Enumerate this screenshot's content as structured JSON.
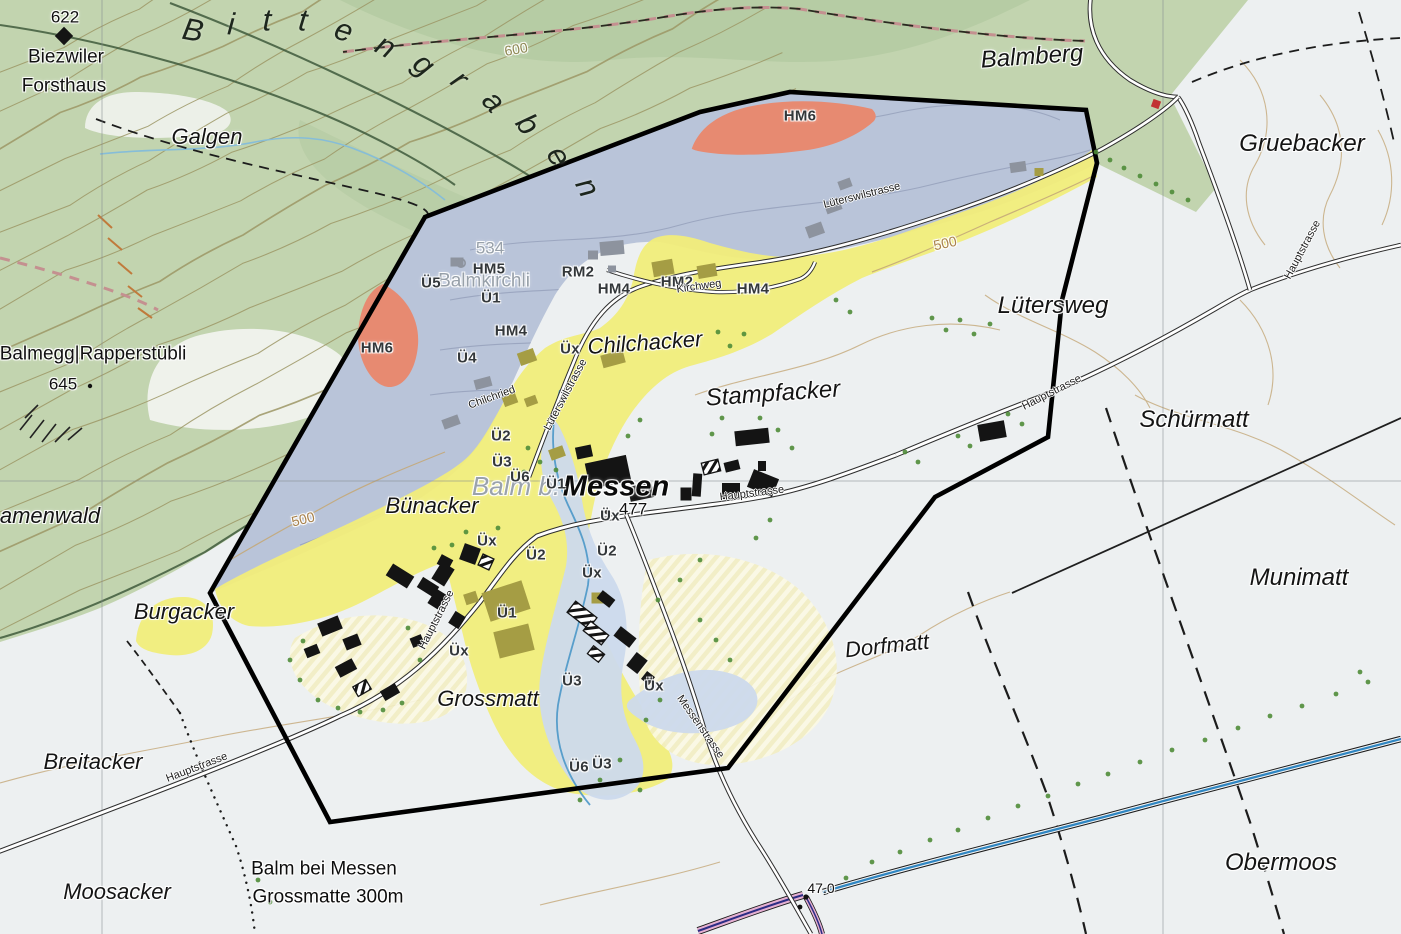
{
  "map": {
    "spread_label": "Bittengraben",
    "labels": [
      {
        "t": "Galgen",
        "x": 207,
        "y": 137,
        "r": 0,
        "c": "place"
      },
      {
        "t": "Balmberg",
        "x": 1032,
        "y": 57,
        "r": -4,
        "c": "place-lg"
      },
      {
        "t": "Gruebacker",
        "x": 1302,
        "y": 144,
        "r": 0,
        "c": "place-lg"
      },
      {
        "t": "Lütersweg",
        "x": 1053,
        "y": 306,
        "r": 0,
        "c": "place-lg"
      },
      {
        "t": "Schürmatt",
        "x": 1194,
        "y": 420,
        "r": 0,
        "c": "place-lg"
      },
      {
        "t": "Munimatt",
        "x": 1299,
        "y": 578,
        "r": 0,
        "c": "place-lg"
      },
      {
        "t": "Stampfacker",
        "x": 773,
        "y": 394,
        "r": -4,
        "c": "place-lg"
      },
      {
        "t": "Obermoos",
        "x": 1281,
        "y": 863,
        "r": 0,
        "c": "place-lg"
      },
      {
        "t": "Dorfmatt",
        "x": 887,
        "y": 646,
        "r": -6,
        "c": "place"
      },
      {
        "t": "Bünacker",
        "x": 432,
        "y": 506,
        "r": 0,
        "c": "place"
      },
      {
        "t": "Burgacker",
        "x": 184,
        "y": 612,
        "r": 0,
        "c": "place"
      },
      {
        "t": "Breitacker",
        "x": 93,
        "y": 762,
        "r": 0,
        "c": "place"
      },
      {
        "t": "Moosacker",
        "x": 117,
        "y": 892,
        "r": 0,
        "c": "place"
      },
      {
        "t": "amenwald",
        "x": 50,
        "y": 516,
        "r": 0,
        "c": "place"
      },
      {
        "t": "Chilchacker",
        "x": 645,
        "y": 343,
        "r": -4,
        "c": "place"
      },
      {
        "t": "Grossmatt",
        "x": 488,
        "y": 699,
        "r": 0,
        "c": "place"
      },
      {
        "t": "Biezwiler",
        "x": 66,
        "y": 57,
        "r": 0,
        "c": "settlement"
      },
      {
        "t": "Forsthaus",
        "x": 64,
        "y": 86,
        "r": 0,
        "c": "settlement"
      },
      {
        "t": "Balmegg|Rapperstübli",
        "x": 93,
        "y": 354,
        "r": 0,
        "c": "settlement"
      },
      {
        "t": "Balmkirchli",
        "x": 484,
        "y": 281,
        "r": 0,
        "c": "gray-name"
      },
      {
        "t": "Balm b.",
        "x": 516,
        "y": 486,
        "r": 0,
        "c": "village-gray"
      },
      {
        "t": "Messen",
        "x": 616,
        "y": 487,
        "r": 0,
        "c": "village-black"
      },
      {
        "t": "534",
        "x": 490,
        "y": 248,
        "r": 0,
        "c": "spot-gray"
      },
      {
        "t": "622",
        "x": 65,
        "y": 17,
        "r": 0,
        "c": "spot"
      },
      {
        "t": "645",
        "x": 63,
        "y": 384,
        "r": 0,
        "c": "spot"
      },
      {
        "t": "477",
        "x": 633,
        "y": 509,
        "r": 0,
        "c": "spot"
      },
      {
        "t": "47.0",
        "x": 821,
        "y": 888,
        "r": 0,
        "c": "spot-sm"
      },
      {
        "t": "Balm bei Messen",
        "x": 324,
        "y": 869,
        "r": 0,
        "c": "bus"
      },
      {
        "t": "Grossmatte 300m",
        "x": 328,
        "y": 897,
        "r": 0,
        "c": "bus"
      },
      {
        "t": "HM6",
        "x": 800,
        "y": 116,
        "r": 0,
        "c": "code"
      },
      {
        "t": "HM6",
        "x": 377,
        "y": 348,
        "r": 0,
        "c": "code"
      },
      {
        "t": "HM5",
        "x": 489,
        "y": 269,
        "r": 0,
        "c": "code"
      },
      {
        "t": "Ü5",
        "x": 431,
        "y": 283,
        "r": 0,
        "c": "code"
      },
      {
        "t": "Ü1",
        "x": 491,
        "y": 298,
        "r": 0,
        "c": "code"
      },
      {
        "t": "RM2",
        "x": 578,
        "y": 272,
        "r": 0,
        "c": "code"
      },
      {
        "t": "HM4",
        "x": 614,
        "y": 289,
        "r": 0,
        "c": "code"
      },
      {
        "t": "HM2",
        "x": 677,
        "y": 282,
        "r": 0,
        "c": "code"
      },
      {
        "t": "HM4",
        "x": 753,
        "y": 289,
        "r": 0,
        "c": "code"
      },
      {
        "t": "HM4",
        "x": 511,
        "y": 331,
        "r": 0,
        "c": "code"
      },
      {
        "t": "Üx",
        "x": 570,
        "y": 349,
        "r": 0,
        "c": "code"
      },
      {
        "t": "Ü4",
        "x": 467,
        "y": 358,
        "r": 0,
        "c": "code"
      },
      {
        "t": "Ü2",
        "x": 501,
        "y": 436,
        "r": 0,
        "c": "code"
      },
      {
        "t": "Ü3",
        "x": 502,
        "y": 462,
        "r": 0,
        "c": "code"
      },
      {
        "t": "Ü6",
        "x": 520,
        "y": 477,
        "r": 0,
        "c": "code"
      },
      {
        "t": "Ü1",
        "x": 556,
        "y": 484,
        "r": 0,
        "c": "code"
      },
      {
        "t": "Üx",
        "x": 610,
        "y": 516,
        "r": 0,
        "c": "code"
      },
      {
        "t": "Ü2",
        "x": 536,
        "y": 555,
        "r": 0,
        "c": "code"
      },
      {
        "t": "Ü2",
        "x": 607,
        "y": 551,
        "r": 0,
        "c": "code"
      },
      {
        "t": "Üx",
        "x": 487,
        "y": 541,
        "r": 0,
        "c": "code"
      },
      {
        "t": "Üx",
        "x": 592,
        "y": 573,
        "r": 0,
        "c": "code"
      },
      {
        "t": "Ü1",
        "x": 507,
        "y": 613,
        "r": 0,
        "c": "code"
      },
      {
        "t": "Üx",
        "x": 459,
        "y": 651,
        "r": 0,
        "c": "code"
      },
      {
        "t": "Ü3",
        "x": 572,
        "y": 681,
        "r": 0,
        "c": "code"
      },
      {
        "t": "Üx",
        "x": 654,
        "y": 686,
        "r": 0,
        "c": "code"
      },
      {
        "t": "Ü6",
        "x": 579,
        "y": 767,
        "r": 0,
        "c": "code"
      },
      {
        "t": "Ü3",
        "x": 602,
        "y": 764,
        "r": 0,
        "c": "code"
      },
      {
        "t": "Lüterswilstrasse",
        "x": 862,
        "y": 196,
        "r": -14,
        "c": "road"
      },
      {
        "t": "Lüterswilstrasse",
        "x": 566,
        "y": 395,
        "r": -62,
        "c": "road"
      },
      {
        "t": "Kirchweg",
        "x": 699,
        "y": 287,
        "r": -8,
        "c": "road"
      },
      {
        "t": "Chilchried",
        "x": 492,
        "y": 398,
        "r": -20,
        "c": "road"
      },
      {
        "t": "Hauptstrasse",
        "x": 752,
        "y": 494,
        "r": -7,
        "c": "road"
      },
      {
        "t": "Hauptstrasse",
        "x": 1052,
        "y": 393,
        "r": -27,
        "c": "road"
      },
      {
        "t": "Hauptstrasse",
        "x": 1303,
        "y": 250,
        "r": -62,
        "c": "road"
      },
      {
        "t": "Hauptstrasse",
        "x": 437,
        "y": 620,
        "r": -63,
        "c": "road"
      },
      {
        "t": "Hauptstrasse",
        "x": 197,
        "y": 768,
        "r": -21,
        "c": "road"
      },
      {
        "t": "Messenstrasse",
        "x": 700,
        "y": 727,
        "r": 55,
        "c": "road"
      },
      {
        "t": "600",
        "x": 516,
        "y": 49,
        "r": -10,
        "c": "contour"
      },
      {
        "t": "500",
        "x": 945,
        "y": 243,
        "r": -12,
        "c": "contour-tan"
      },
      {
        "t": "500",
        "x": 303,
        "y": 519,
        "r": -14,
        "c": "contour-tan"
      }
    ],
    "colors": {
      "forest": "#c2d4af",
      "forest_dark": "#b2c9a0",
      "terrain": "#edf0f1",
      "zone_blue": "#b6c1d7",
      "zone_yellow": "#f1ed7a",
      "zone_yellow_pale": "#f3efc4",
      "zone_red": "#e78a71",
      "flood_blue": "#ccd9ec",
      "water": "#4a97c8",
      "canal": "#2f86c2",
      "boundary": "#000000",
      "building": "#141414",
      "building_khaki": "#a59d44",
      "building_gray": "#8d939e",
      "tree": "#4f8c38",
      "contour_olive": "#9d9766",
      "contour_tan": "#c4a878",
      "pink_line": "#e5b0d2",
      "grid": "#84898e"
    }
  }
}
